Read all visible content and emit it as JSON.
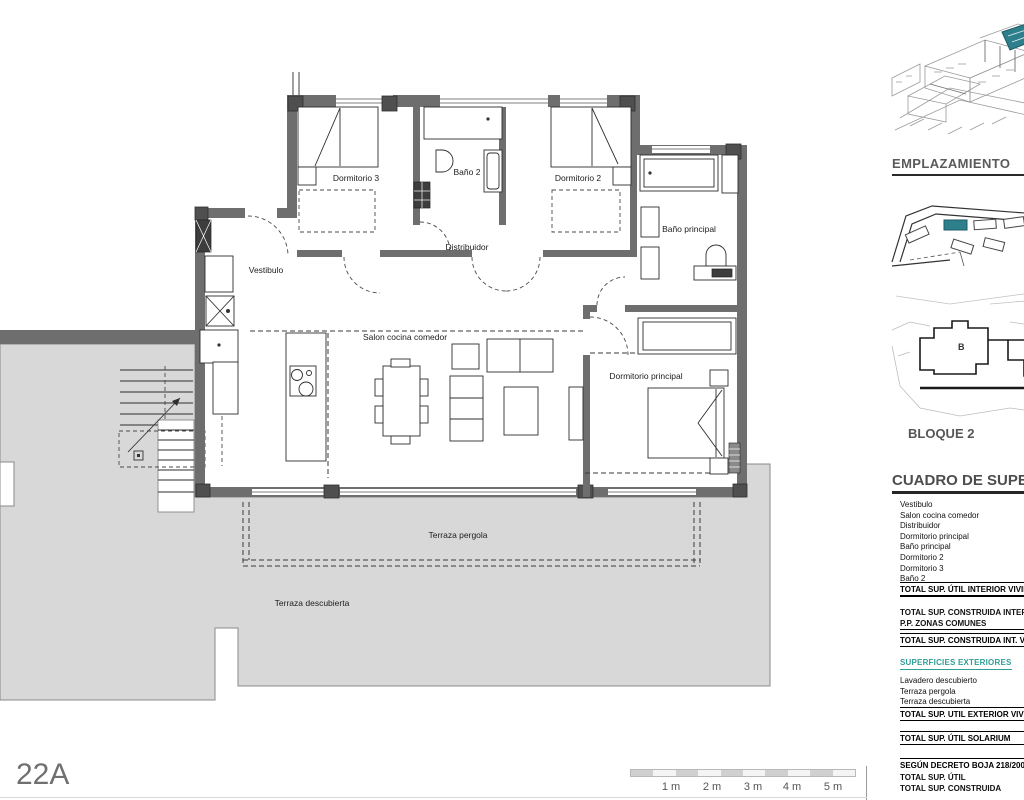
{
  "plan": {
    "code": "22A",
    "rooms": {
      "dormitorio3": "Dormitorio 3",
      "bano2": "Baño 2",
      "dormitorio2": "Dormitorio 2",
      "bano_principal": "Baño principal",
      "vestibulo": "Vestibulo",
      "distribuidor": "Distribuidor",
      "salon": "Salon cocina comedor",
      "dormitorio_principal": "Dormitorio principal",
      "terraza_pergola": "Terraza pergola",
      "terraza_descubierta": "Terraza descubierta"
    }
  },
  "scalebar": {
    "labels": [
      "1 m",
      "2 m",
      "3 m",
      "4 m",
      "5 m"
    ]
  },
  "sidebar": {
    "emplazamiento_title": "EMPLAZAMIENTO",
    "bloque_label": "BLOQUE 2",
    "block_letter": "B",
    "cuadro_title": "CUADRO DE SUPERFICIES",
    "table": {
      "interior_rows": [
        "Vestibulo",
        "Salon cocina comedor",
        "Distribuidor",
        "Dormitorio principal",
        "Baño principal",
        "Dormitorio 2",
        "Dormitorio 3",
        "Baño 2"
      ],
      "total_util_interior": "TOTAL SUP. ÚTIL INTERIOR VIVIENDA",
      "construida_interior": "TOTAL SUP. CONSTRUIDA INTERIOR VIVIENDA",
      "pp_zonas_comunes": "P.P. ZONAS COMUNES",
      "total_construida_int": "TOTAL SUP. CONSTRUIDA INT. VIVIENDA",
      "exteriores_title": "SUPERFICIES EXTERIORES",
      "exterior_rows": [
        "Lavadero descubierto",
        "Terraza pergola",
        "Terraza descubierta"
      ],
      "total_util_exterior": "TOTAL SUP. UTIL EXTERIOR VIVIENDA",
      "total_util_solarium": "TOTAL SUP. ÚTIL SOLARIUM",
      "decreto_title": "SEGÚN DECRETO BOJA 218/2005",
      "decreto_rows": [
        "TOTAL SUP. ÚTIL",
        "TOTAL SUP. CONSTRUIDA"
      ]
    }
  },
  "colors": {
    "accent_teal": "#2f9e96",
    "highlight_teal": "#2e7f8c",
    "wall_gray": "#6e6e6e",
    "terrace_gray": "#d8d8d8"
  }
}
